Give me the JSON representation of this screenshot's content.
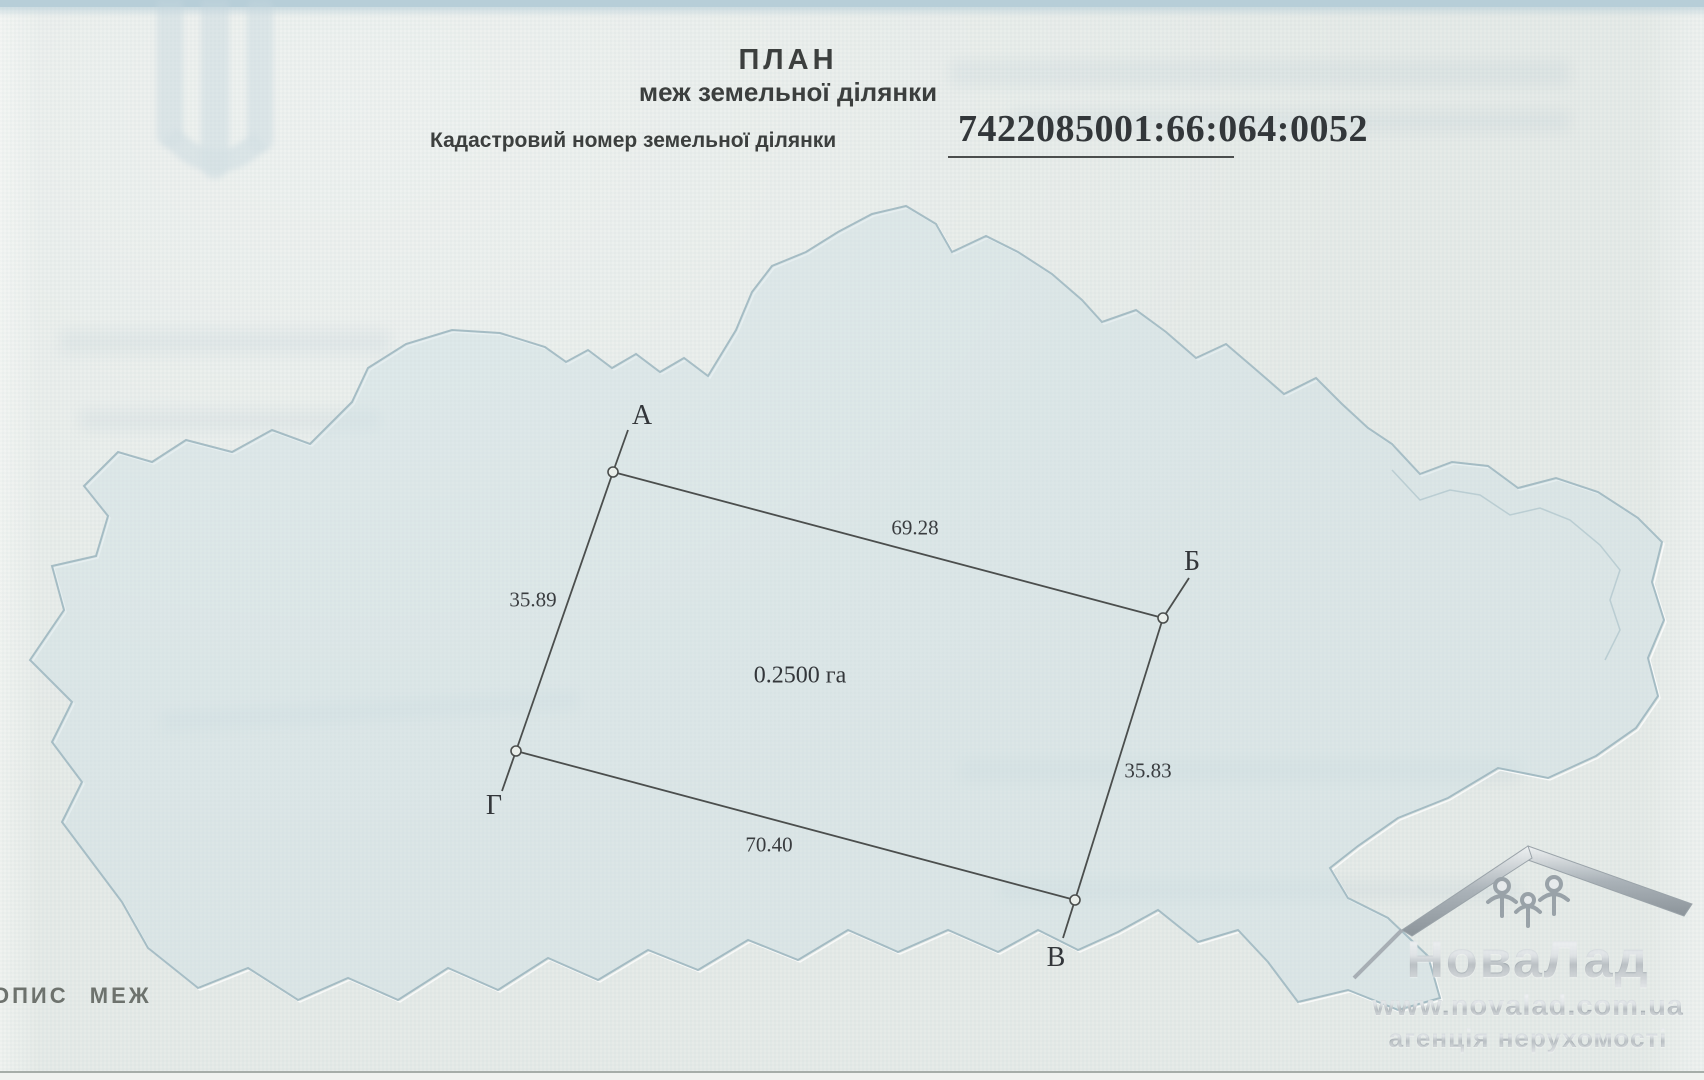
{
  "document": {
    "title": "ПЛАН",
    "subtitle": "меж земельної ділянки",
    "cadastral_label": "Кадастровий номер земельної ділянки",
    "cadastral_number": "7422085001:66:064:0052",
    "footer_left": "ОПИС МЕЖ"
  },
  "plot": {
    "area": "0.2500 га",
    "vertices": [
      {
        "name": "А"
      },
      {
        "name": "Б"
      },
      {
        "name": "В"
      },
      {
        "name": "Г"
      }
    ],
    "sides": [
      {
        "from": "А",
        "to": "Б",
        "length": "69.28"
      },
      {
        "from": "Б",
        "to": "В",
        "length": "35.83"
      },
      {
        "from": "В",
        "to": "Г",
        "length": "70.40"
      },
      {
        "from": "Г",
        "to": "А",
        "length": "35.89"
      }
    ]
  },
  "agency_watermark": {
    "brand": "НоваЛад",
    "website": "www.novalad.com.ua",
    "tagline": "агенція нерухомості"
  },
  "colors": {
    "paper": "#e4e9e6",
    "map_fill": "#d7e3e7",
    "map_stroke": "#9fb8c0",
    "ink": "#3a3d3c",
    "boundary_line": "#4b4e4d",
    "silver_text": "#b2bac0"
  }
}
